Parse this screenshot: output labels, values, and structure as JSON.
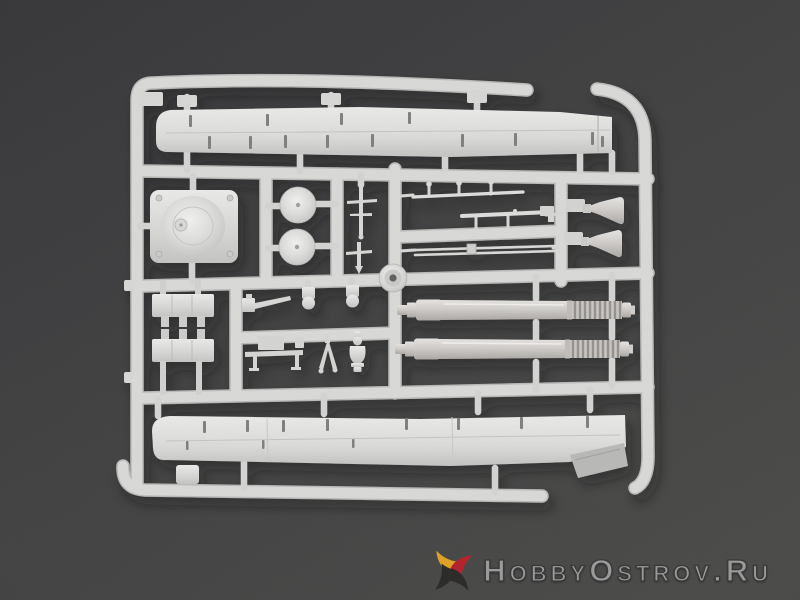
{
  "scene": {
    "description": "Product photograph: light grey injection-moulded plastic model-kit sprue with tank parts (hull side panels, turret roof with dome, hatch discs, two gun barrels with ribbed ends, muzzle cones, brackets and small fittings) on a dark grey background",
    "background_top_color": "#37373a",
    "background_bottom_color": "#4b4b49",
    "plastic_color": "#d6d6d4",
    "plastic_highlight": "#eaeae8",
    "plastic_shadow_edge": "#b9b9b7",
    "slot_color": "#7f7f7b"
  },
  "sprue": {
    "parts": [
      "outer-frame-rails",
      "upper-hull-side-panel",
      "turret-roof-panel",
      "hatch-disc-upper",
      "hatch-disc-lower",
      "periscope-rods",
      "antenna-rod-upper",
      "antenna-rod-lower",
      "cleaning-rod-pair",
      "muzzle-cone-upper",
      "muzzle-cone-lower",
      "idler-wheel",
      "suspension-bracket-upper",
      "suspension-bracket-lower",
      "hull-machine-gun",
      "shackle-pendant-left",
      "shackle-pendant-right",
      "equipment-bench",
      "tow-clevis",
      "vase-shaped-fitting",
      "gun-barrel-upper",
      "gun-barrel-lower",
      "lower-hull-side-panel",
      "small-stowage-box"
    ]
  },
  "watermark": {
    "text": "HobbyOstrov.Ru",
    "text_color": "#9a9a9a",
    "outline_color": "#3a3a3a",
    "star_yellow": "#dfa226",
    "star_red": "#b5242c",
    "star_dark": "#2e2c2a"
  }
}
